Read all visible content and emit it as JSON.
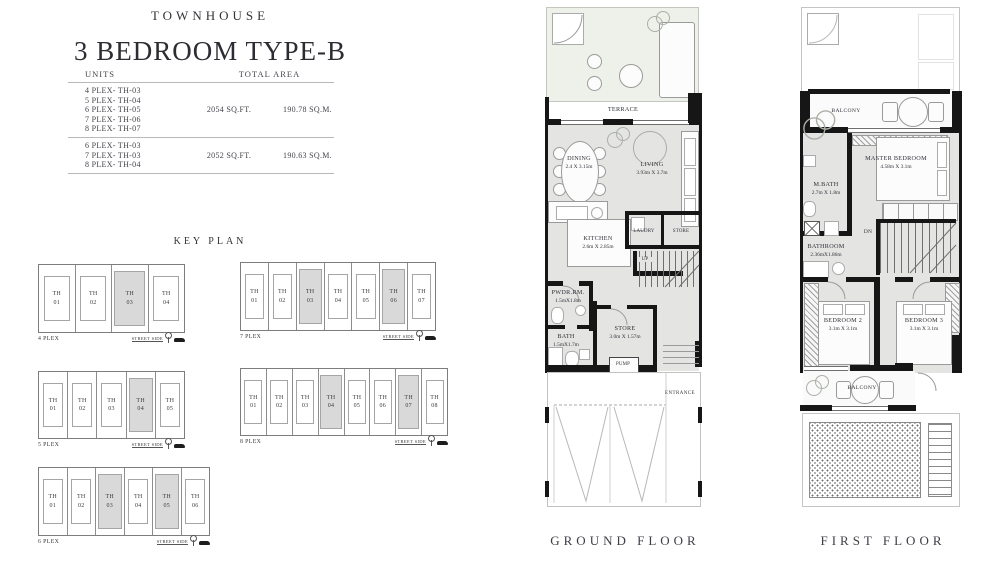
{
  "header": {
    "brand": "TOWNHOUSE",
    "title": "3 BEDROOM TYPE-B"
  },
  "units_table": {
    "col_units": "UNITS",
    "col_area": "TOTAL AREA",
    "groups": [
      {
        "units": [
          "4 PLEX- TH-03",
          "5 PLEX- TH-04",
          "6 PLEX- TH-05",
          "7 PLEX- TH-06",
          "8 PLEX- TH-07"
        ],
        "sqft": "2054 SQ.FT.",
        "sqm": "190.78 SQ.M."
      },
      {
        "units": [
          "6 PLEX- TH-03",
          "7 PLEX- TH-03",
          "8 PLEX- TH-04"
        ],
        "sqft": "2052 SQ.FT.",
        "sqm": "190.63 SQ.M."
      }
    ]
  },
  "key_plan": {
    "heading": "KEY PLAN",
    "street_side_label": "STREET SIDE",
    "plexes": [
      {
        "name": "4 PLEX",
        "units": [
          {
            "code": "TH",
            "num": "01",
            "highlight": false
          },
          {
            "code": "TH",
            "num": "02",
            "highlight": false
          },
          {
            "code": "TH",
            "num": "03",
            "highlight": true
          },
          {
            "code": "TH",
            "num": "04",
            "highlight": false
          }
        ]
      },
      {
        "name": "7 PLEX",
        "units": [
          {
            "code": "TH",
            "num": "01",
            "highlight": false
          },
          {
            "code": "TH",
            "num": "02",
            "highlight": false
          },
          {
            "code": "TH",
            "num": "03",
            "highlight": true
          },
          {
            "code": "TH",
            "num": "04",
            "highlight": false
          },
          {
            "code": "TH",
            "num": "05",
            "highlight": false
          },
          {
            "code": "TH",
            "num": "06",
            "highlight": true
          },
          {
            "code": "TH",
            "num": "07",
            "highlight": false
          }
        ]
      },
      {
        "name": "5 PLEX",
        "units": [
          {
            "code": "TH",
            "num": "01",
            "highlight": false
          },
          {
            "code": "TH",
            "num": "02",
            "highlight": false
          },
          {
            "code": "TH",
            "num": "03",
            "highlight": false
          },
          {
            "code": "TH",
            "num": "04",
            "highlight": true
          },
          {
            "code": "TH",
            "num": "05",
            "highlight": false
          }
        ]
      },
      {
        "name": "8 PLEX",
        "units": [
          {
            "code": "TH",
            "num": "01",
            "highlight": false
          },
          {
            "code": "TH",
            "num": "02",
            "highlight": false
          },
          {
            "code": "TH",
            "num": "03",
            "highlight": false
          },
          {
            "code": "TH",
            "num": "04",
            "highlight": true
          },
          {
            "code": "TH",
            "num": "05",
            "highlight": false
          },
          {
            "code": "TH",
            "num": "06",
            "highlight": false
          },
          {
            "code": "TH",
            "num": "07",
            "highlight": true
          },
          {
            "code": "TH",
            "num": "08",
            "highlight": false
          }
        ]
      },
      {
        "name": "6 PLEX",
        "units": [
          {
            "code": "TH",
            "num": "01",
            "highlight": false
          },
          {
            "code": "TH",
            "num": "02",
            "highlight": false
          },
          {
            "code": "TH",
            "num": "03",
            "highlight": true
          },
          {
            "code": "TH",
            "num": "04",
            "highlight": false
          },
          {
            "code": "TH",
            "num": "05",
            "highlight": true
          },
          {
            "code": "TH",
            "num": "06",
            "highlight": false
          }
        ]
      }
    ]
  },
  "ground_floor": {
    "label": "GROUND FLOOR",
    "terrace": "TERRACE",
    "dining": {
      "name": "DINING",
      "dims": "2.4 X 3.15m"
    },
    "living": {
      "name": "LIVING",
      "dims": "3.93m X 3.7m"
    },
    "kitchen": {
      "name": "KITCHEN",
      "dims": "2.6m X 2.85m"
    },
    "laundry": "LAUDRY",
    "store_upper": "STORE",
    "up": "UP",
    "powder": {
      "name": "PWDR.RM.",
      "dims": "1.5mX1.8m"
    },
    "bath": {
      "name": "BATH",
      "dims": "1.5mX1.7m"
    },
    "store": {
      "name": "STORE",
      "dims": "3.0m X 1.57m"
    },
    "pump": "PUMP",
    "entrance": "ENTRANCE"
  },
  "first_floor": {
    "label": "FIRST FLOOR",
    "balcony_top": "BALCONY",
    "master": {
      "name": "MASTER BEDROOM",
      "dims": "4.58m X 3.1m"
    },
    "mbath": {
      "name": "M.BATH",
      "dims": "2.7m X 1.8m"
    },
    "bathroom": {
      "name": "BATHROOM",
      "dims": "2.36mX1.86m"
    },
    "dn": "DN",
    "bedroom2": {
      "name": "BEDROOM 2",
      "dims": "3.1m X 3.1m"
    },
    "bedroom3": {
      "name": "BEDROOM 3",
      "dims": "3.1m X 3.1m"
    },
    "balcony_bottom": "BALCONY"
  },
  "colors": {
    "wall": "#161616",
    "floor_fill": "#e4e4e2",
    "terrace_fill": "#edf1e9",
    "highlight_fill": "#d9d9d9",
    "text": "#3a3a40"
  }
}
